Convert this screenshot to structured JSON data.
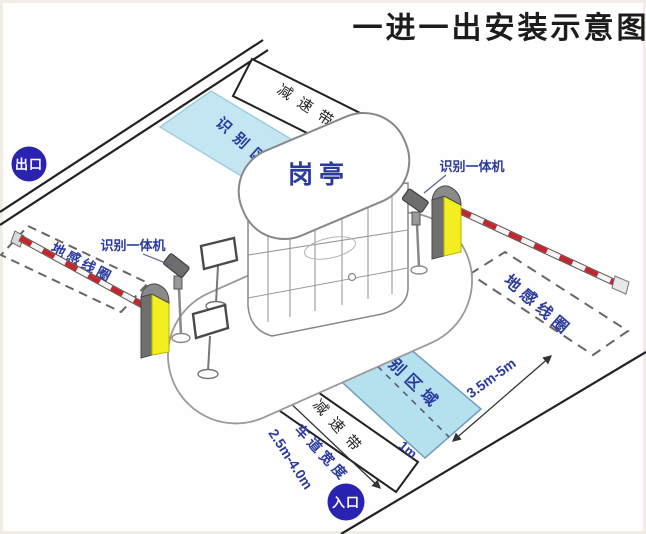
{
  "title": "一进一出安装示意图",
  "badges": {
    "exit": "出口",
    "entrance": "入口"
  },
  "booth": {
    "label": "岗亭"
  },
  "exit_lane": {
    "speed_bump": "减速带",
    "recognition_zone": "识别区域",
    "detector_loop": "地感线圈",
    "camera": "识别一体机"
  },
  "entrance_lane": {
    "speed_bump": "减速带",
    "recognition_zone": "识别区域",
    "detector_loop": "地感线圈",
    "camera": "识别一体机",
    "lane_width_label": "车道宽度",
    "lane_width_value": "2.5m-4.0m",
    "loop_to_zone_distance": "3.5m-5m",
    "stop_line_distance": "1m"
  },
  "colors": {
    "badge_blue": "#2a23b2",
    "zone_blue": "#bce3f1",
    "machine_yellow": "#f2ee1f",
    "arm_red": "#c1272d",
    "label_navy": "#2b3a9e",
    "line_black": "#222222"
  }
}
